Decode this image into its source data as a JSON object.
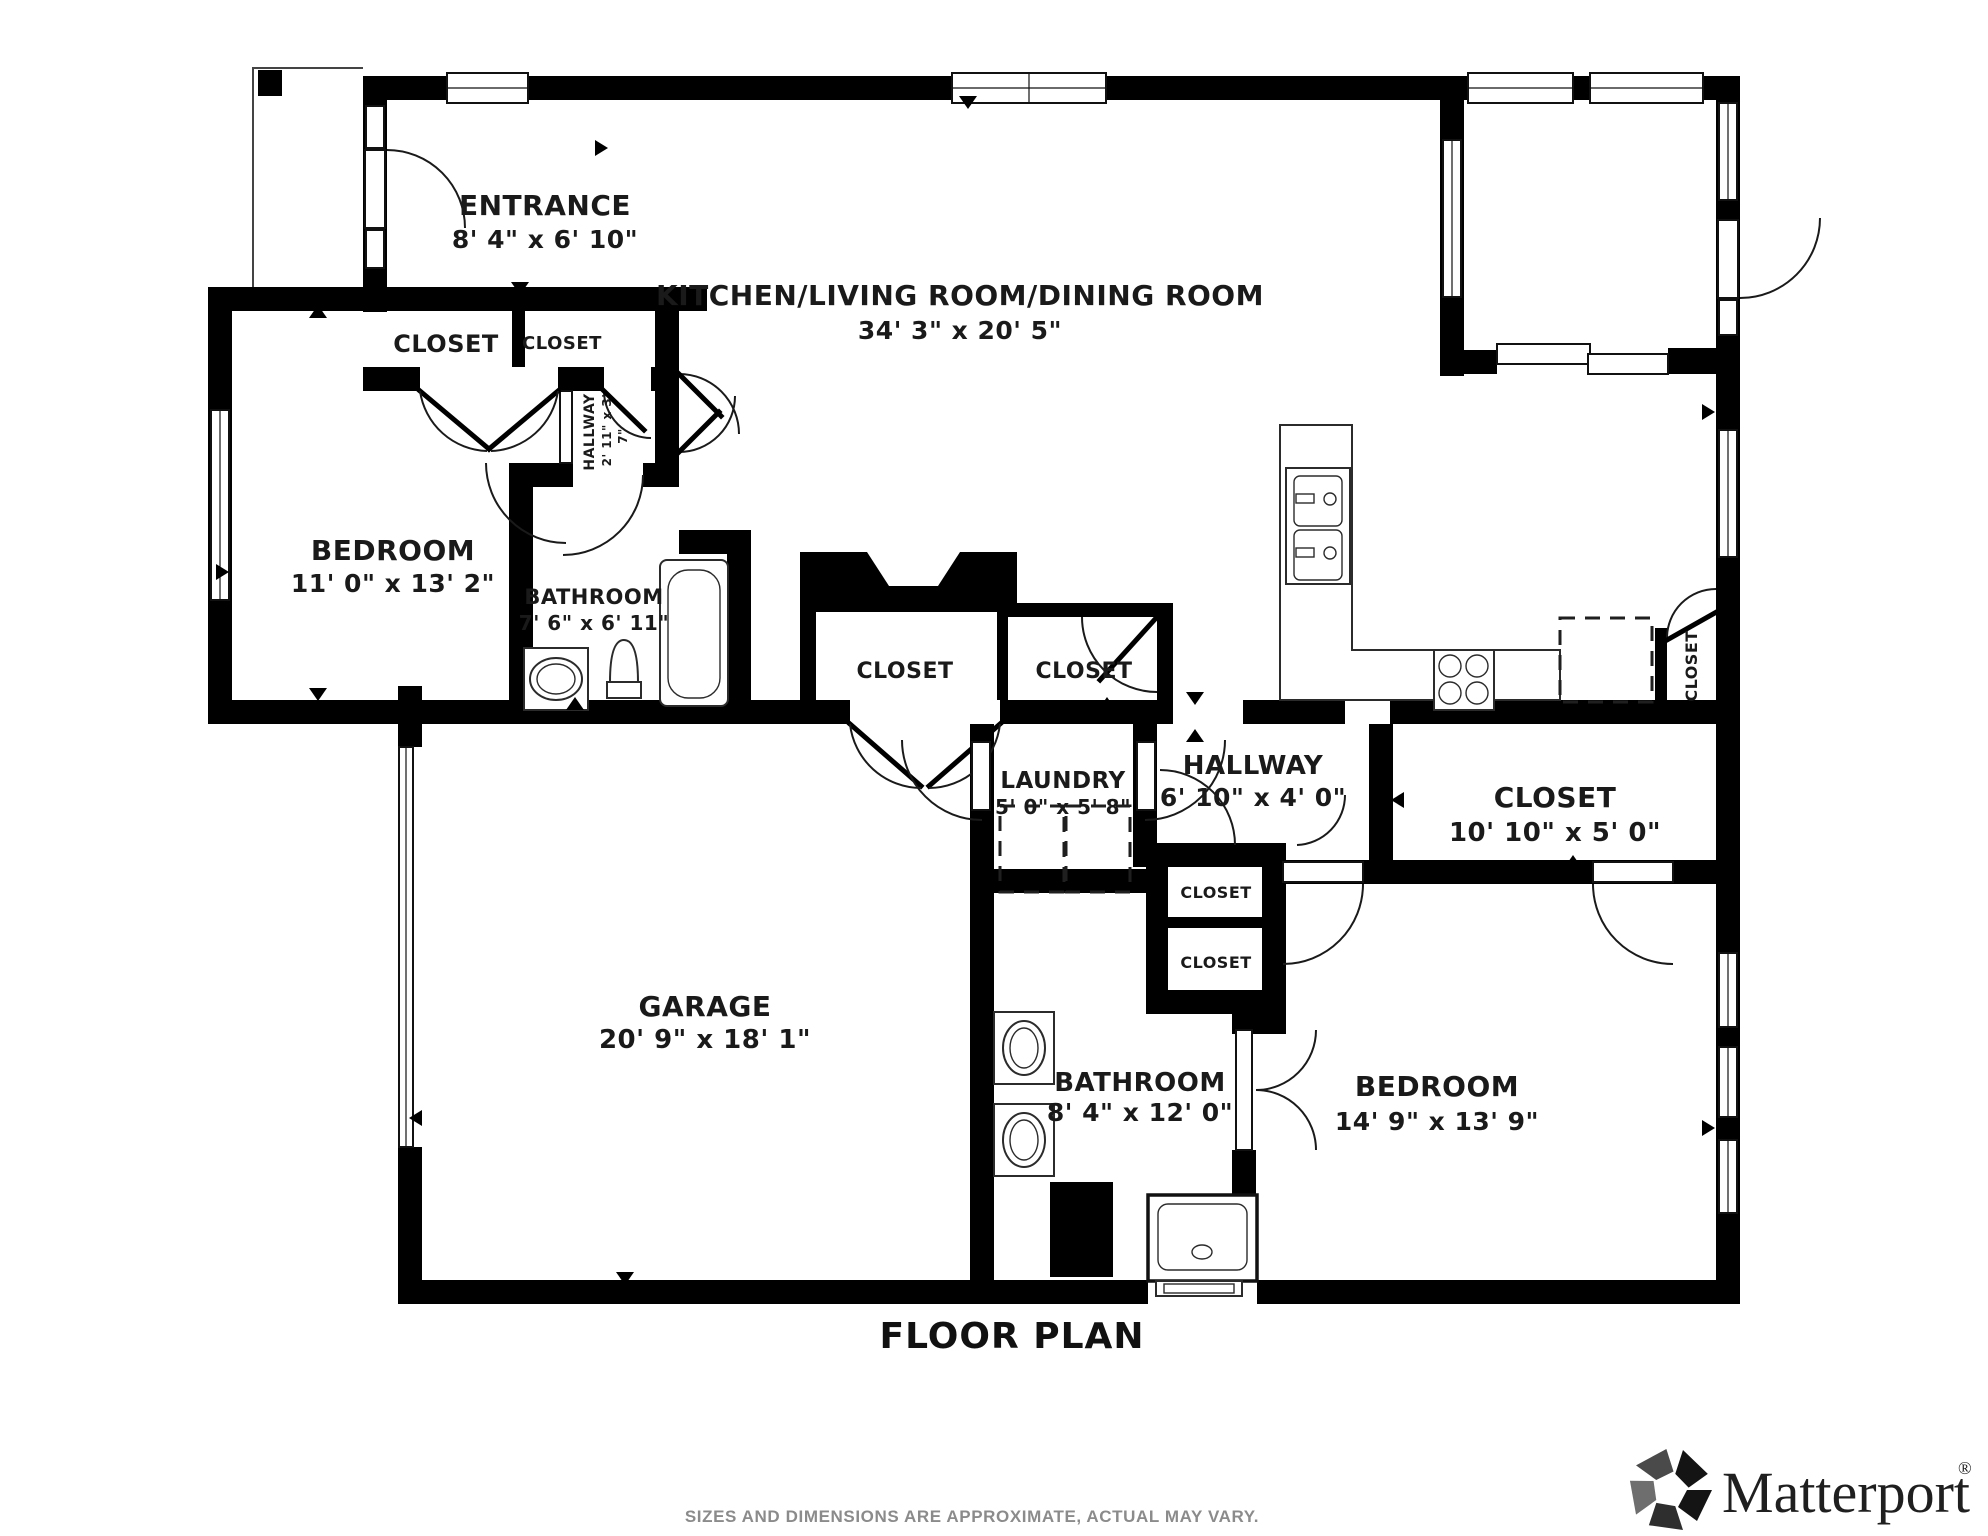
{
  "floor_plan": {
    "title": "FLOOR PLAN",
    "disclaimer": "SIZES AND DIMENSIONS ARE APPROXIMATE, ACTUAL MAY VARY.",
    "brand": {
      "name": "Matterport",
      "registered_mark": "®",
      "icon": "matterport-pinwheel-icon"
    },
    "colors": {
      "wall": "#000000",
      "line": "#2b2b2b",
      "disclaimer_text": "#8b8b8b",
      "logo_text": "#1f1f1f",
      "background": "#ffffff"
    },
    "rooms": {
      "entrance": {
        "name": "ENTRANCE",
        "dimensions": "8' 4\" x 6' 10\""
      },
      "kitchen_living_dining": {
        "name": "KITCHEN/LIVING ROOM/DINING ROOM",
        "dimensions": "34' 3\" x 20' 5\""
      },
      "entry_closet_left": {
        "name": "CLOSET"
      },
      "entry_closet_right": {
        "name": "CLOSET"
      },
      "hall_small": {
        "name": "HALLWAY",
        "dimensions": "2' 11\" x 3' 7\"",
        "dimensions_line_1": "2' 11\" x 3'",
        "dimensions_line_2": "7\""
      },
      "bedroom_left": {
        "name": "BEDROOM",
        "dimensions": "11' 0\" x 13' 2\""
      },
      "bathroom_top": {
        "name": "BATHROOM",
        "dimensions": "7' 6\" x 6' 11\""
      },
      "mid_closet_left": {
        "name": "CLOSET"
      },
      "mid_closet_right": {
        "name": "CLOSET"
      },
      "laundry": {
        "name": "LAUNDRY",
        "dimensions": "5' 0\" x 5' 8\""
      },
      "hallway_main": {
        "name": "HALLWAY",
        "dimensions": "6' 10\" x 4' 0\""
      },
      "closet_large": {
        "name": "CLOSET",
        "dimensions": "10' 10\" x 5' 0\""
      },
      "small_closet_upper": {
        "name": "CLOSET"
      },
      "small_closet_lower": {
        "name": "CLOSET"
      },
      "pantry_closet": {
        "name": "CLOSET"
      },
      "garage": {
        "name": "GARAGE",
        "dimensions": "20' 9\" x 18' 1\""
      },
      "bathroom_bottom": {
        "name": "BATHROOM",
        "dimensions": "8' 4\" x 12' 0\""
      },
      "bedroom_right": {
        "name": "BEDROOM",
        "dimensions": "14' 9\" x 13' 9\""
      }
    }
  }
}
